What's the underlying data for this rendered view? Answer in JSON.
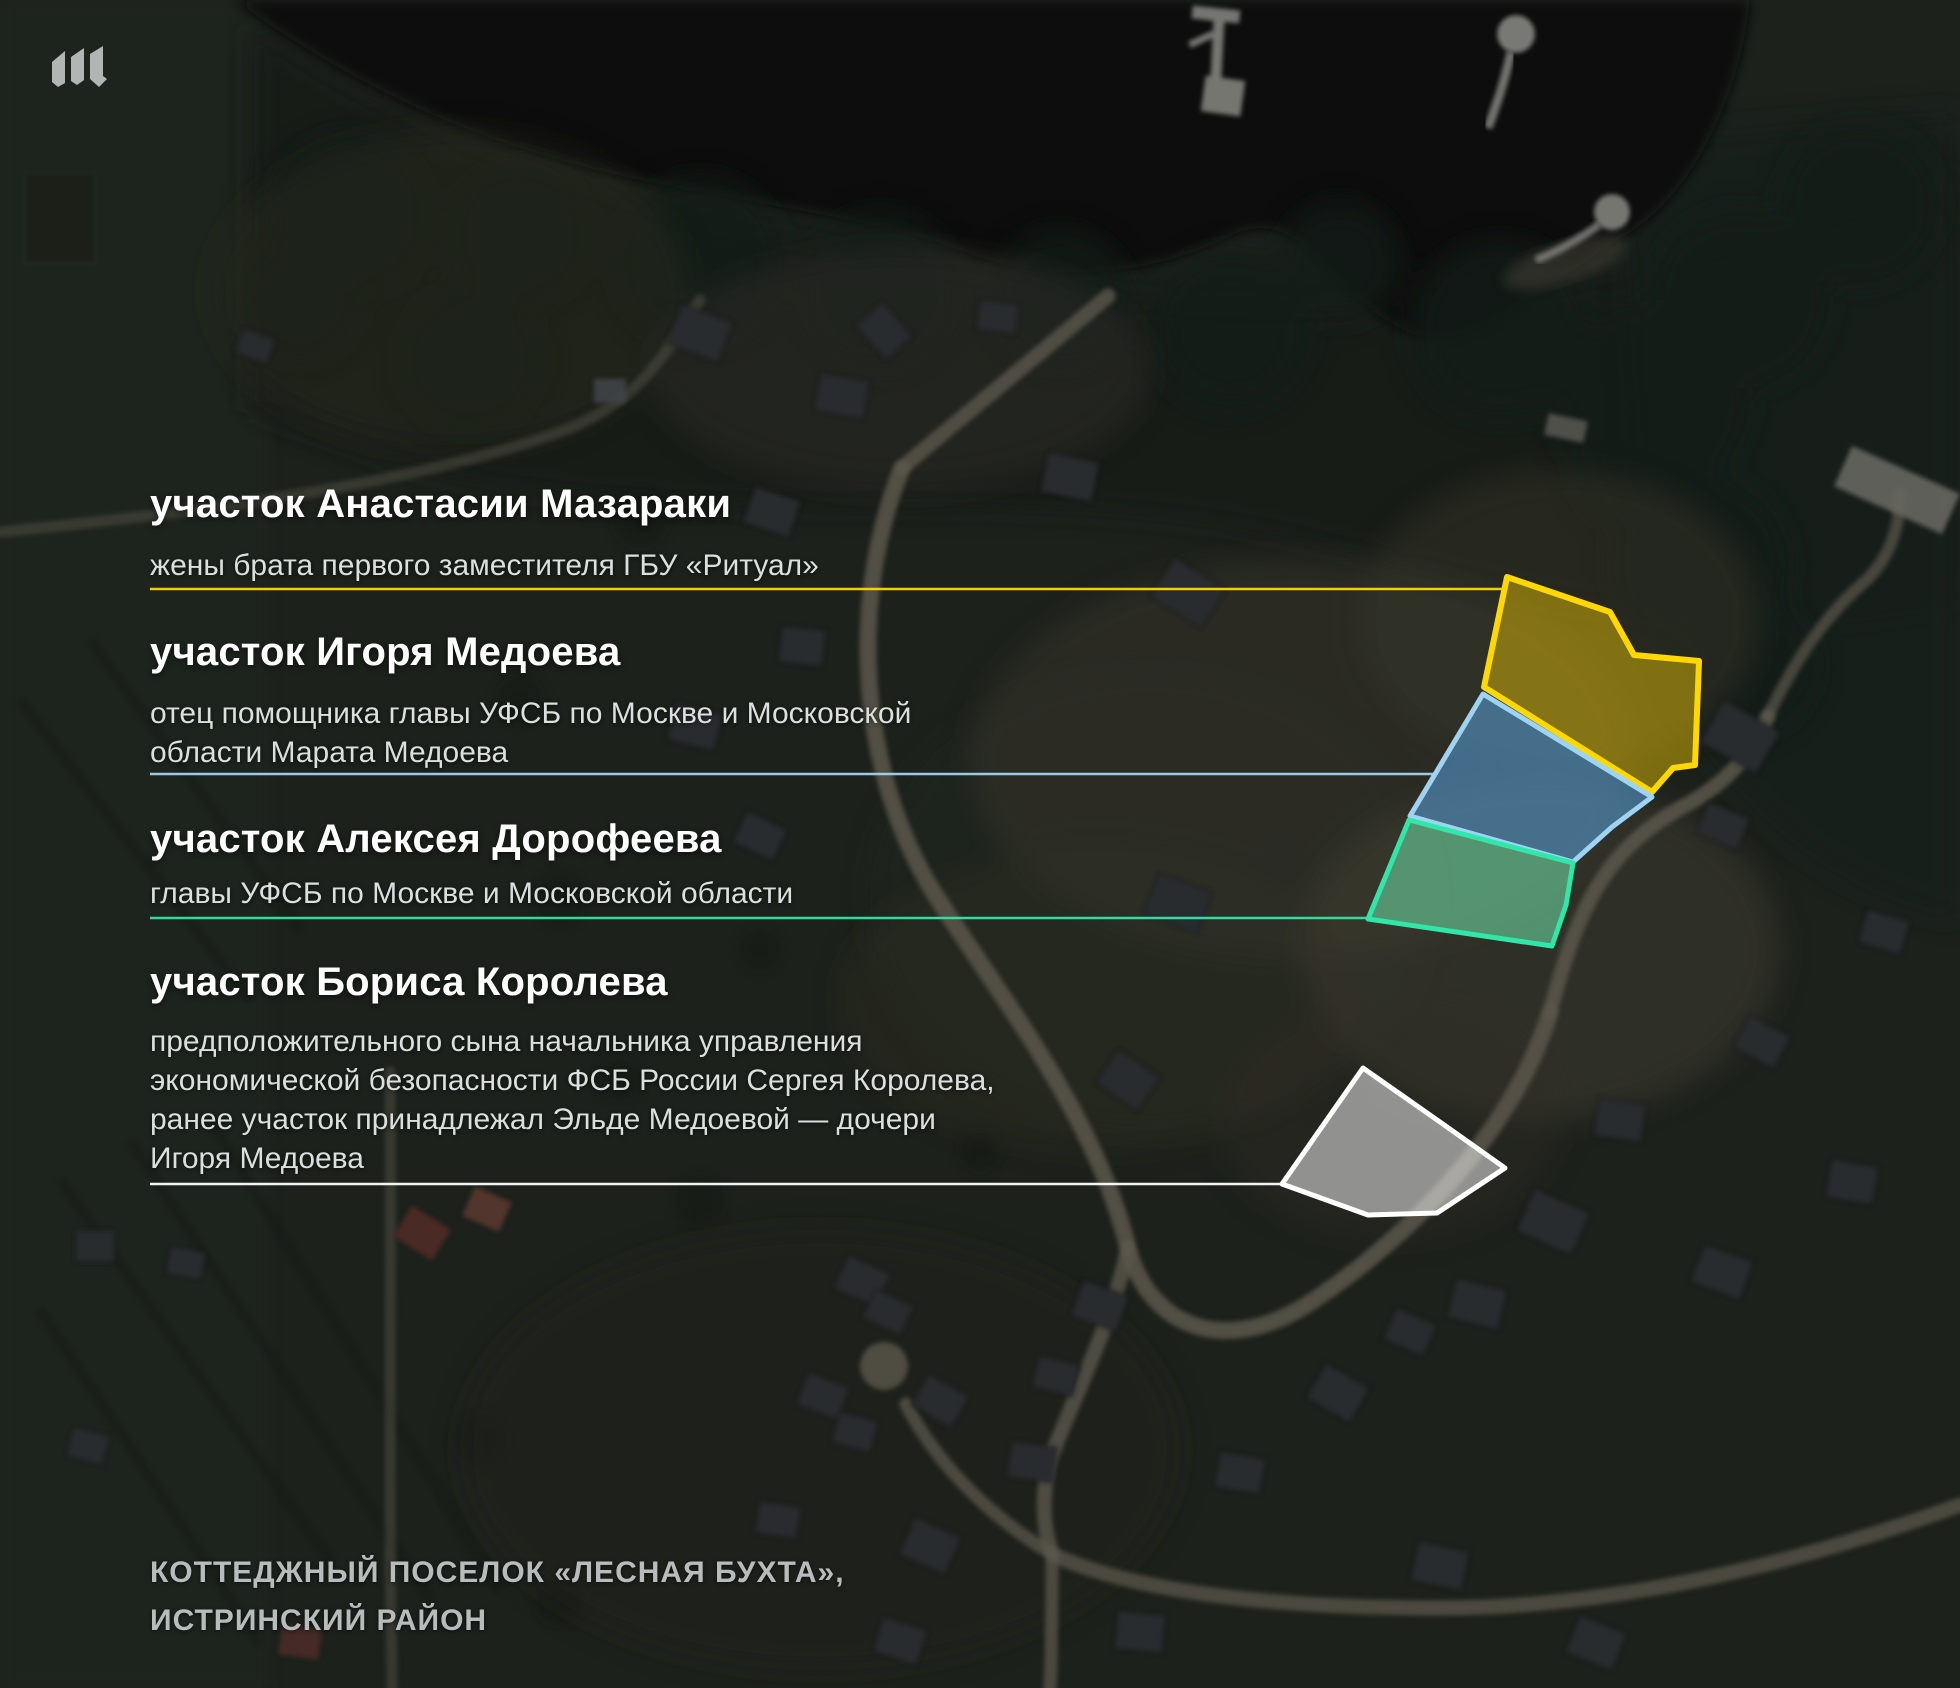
{
  "logo": {
    "label": "Meduza"
  },
  "labels": [
    {
      "title": "участок Анастасии Мазараки",
      "subtitle": "жены брата первого заместителя ГБУ «Ритуал»",
      "color": "#ffd800",
      "fill": "rgba(255,211,0,0.42)"
    },
    {
      "title": "участок Игоря Медоева",
      "subtitle": "отец помощника главы УФСБ по Москве и Московской\nобласти Марата Медоева",
      "color": "#9fd3f4",
      "fill": "rgba(86,162,221,0.55)"
    },
    {
      "title": "участок Алексея Дорофеева",
      "subtitle": "главы УФСБ по Москве и Московской области",
      "color": "#2ee7a9",
      "fill": "rgba(116,238,178,0.52)"
    },
    {
      "title": "участок Бориса Королева",
      "subtitle": "предположительного сына начальника управления\nэкономической безопасности ФСБ России Сергея Королева,\nранее участок принадлежал Эльде Медоевой — дочери\nИгоря Медоева",
      "color": "#ffffff",
      "fill": "rgba(255,255,255,0.5)"
    }
  ],
  "caption": "КОТТЕДЖНЫЙ ПОСЕЛОК «ЛЕСНАЯ БУХТА»,\nИСТРИНСКИЙ РАЙОН"
}
